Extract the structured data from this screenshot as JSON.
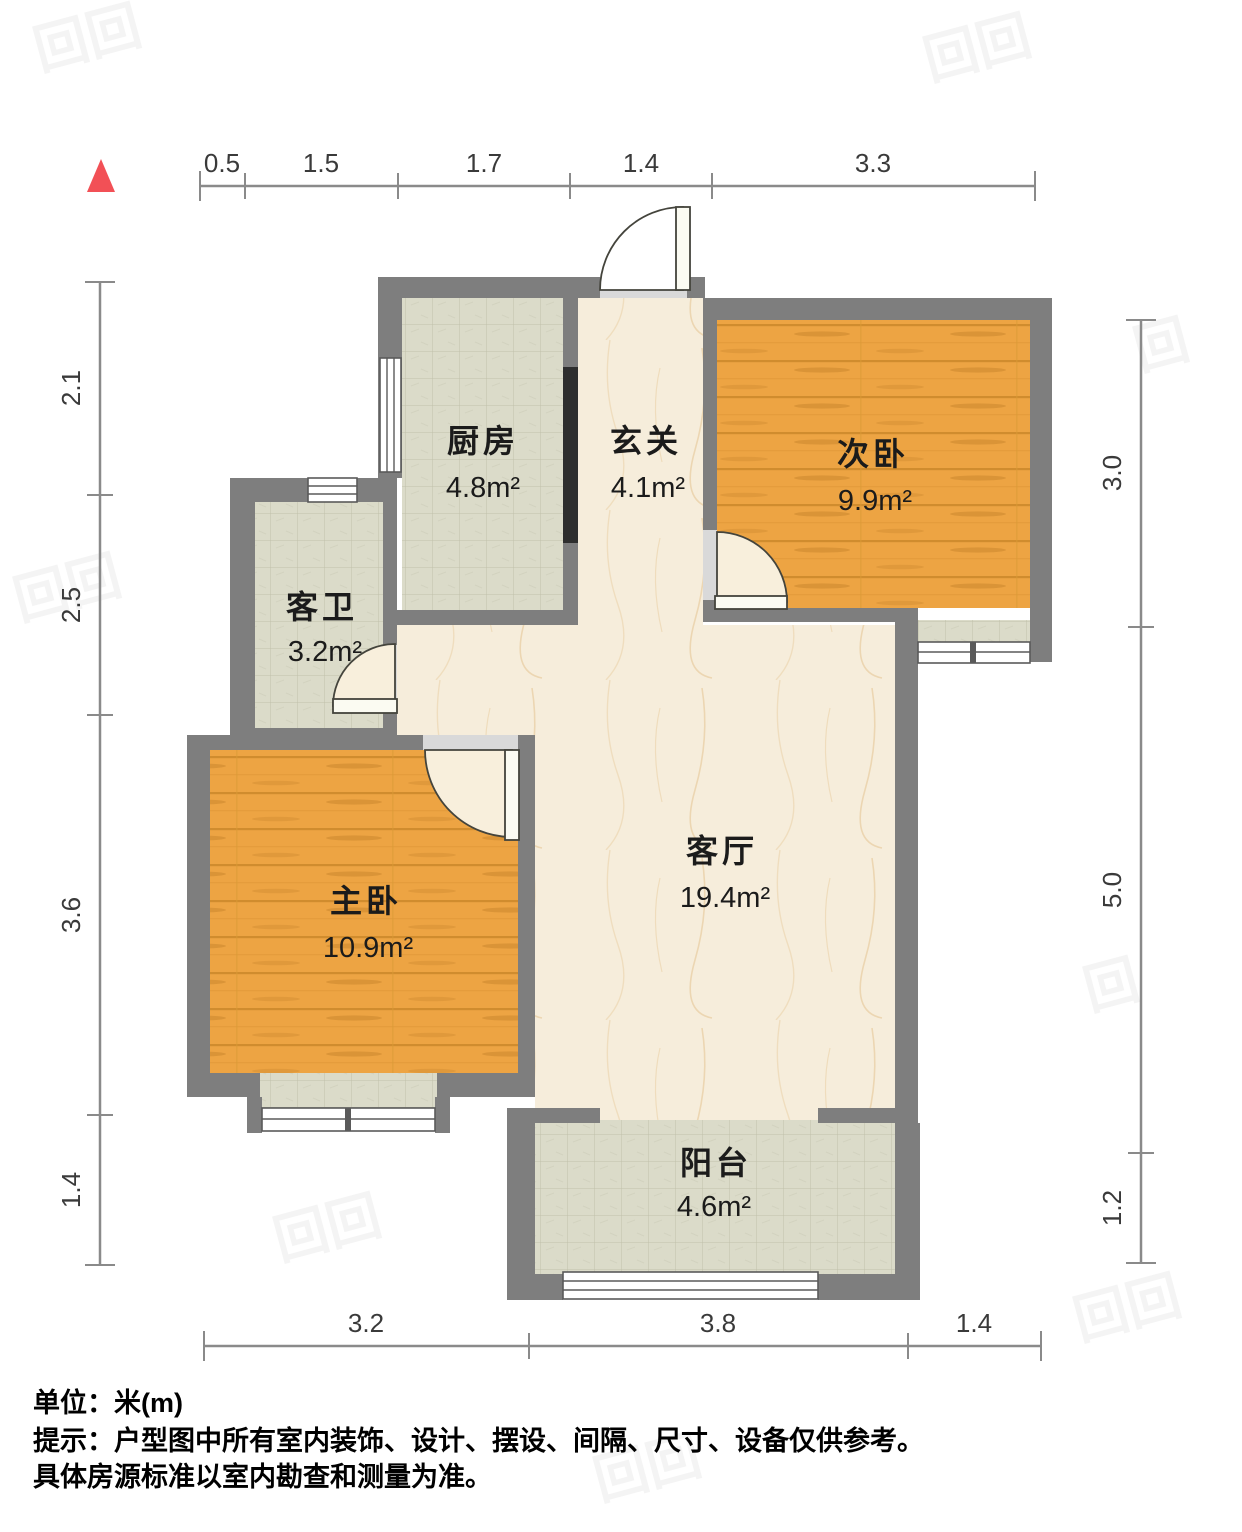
{
  "plan": {
    "unit_scale": "1m ≈ 100px",
    "north_icon": "triangle-up",
    "watermark_glyph": "回"
  },
  "dimensions": {
    "top": [
      "0.5",
      "1.5",
      "1.7",
      "1.4",
      "3.3"
    ],
    "left": [
      "2.1",
      "2.5",
      "3.6",
      "1.4"
    ],
    "right": [
      "3.0",
      "5.0",
      "1.2"
    ],
    "bottom": [
      "3.2",
      "3.8",
      "1.4"
    ]
  },
  "rooms": {
    "kitchen": {
      "name": "厨房",
      "area": "4.8m²"
    },
    "foyer": {
      "name": "玄关",
      "area": "4.1m²"
    },
    "second_bedroom": {
      "name": "次卧",
      "area": "9.9m²"
    },
    "guest_bathroom": {
      "name": "客卫",
      "area": "3.2m²"
    },
    "master_bedroom": {
      "name": "主卧",
      "area": "10.9m²"
    },
    "living_room": {
      "name": "客厅",
      "area": "19.4m²"
    },
    "balcony": {
      "name": "阳台",
      "area": "4.6m²"
    }
  },
  "footer": {
    "unit_line": "单位：米(m)",
    "note_line1": "提示：户型图中所有室内装饰、设计、摆设、间隔、尺寸、设备仅供参考。",
    "note_line2": "具体房源标准以室内勘查和测量为准。"
  },
  "colors": {
    "wall": "#7e7e7e",
    "wood_floor": "#eda443",
    "tile_floor": "#dbdbc9",
    "marble_floor": "#f6eddb",
    "north_arrow": "#f25056"
  }
}
